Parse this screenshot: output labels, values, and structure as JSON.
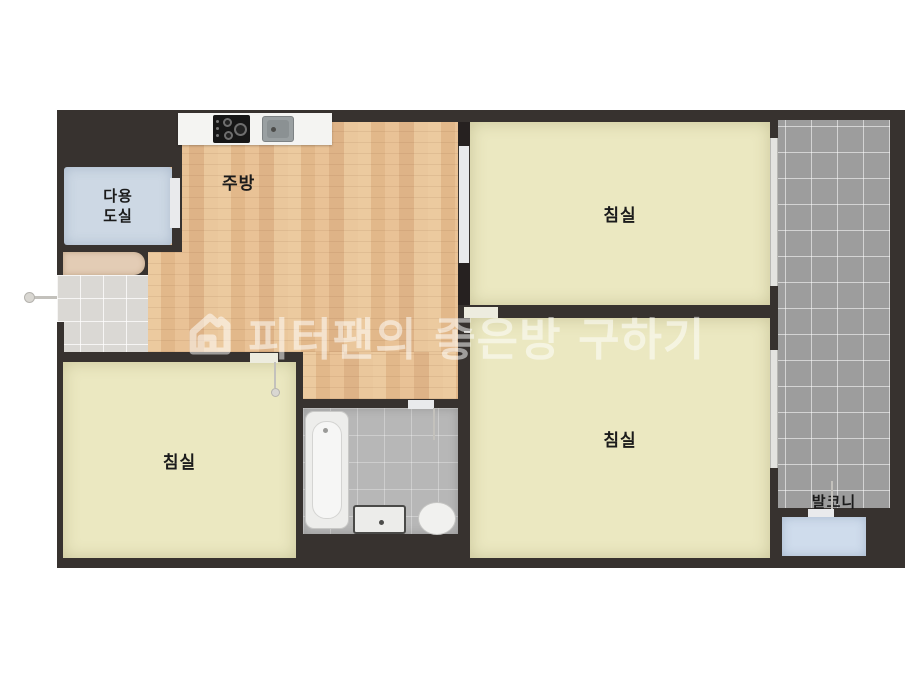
{
  "watermark": {
    "icon": "house-logo-icon",
    "text": "피터팬의 좋은방 구하기"
  },
  "rooms": {
    "kitchen": {
      "label": "주방"
    },
    "utility_room": {
      "label": "다용도실",
      "label_line1": "다용",
      "label_line2": "도실"
    },
    "bedroom_top_right": {
      "label": "침실"
    },
    "bedroom_bottom_right": {
      "label": "침실"
    },
    "bedroom_bottom_left": {
      "label": "침실"
    },
    "balcony": {
      "label": "발코니"
    }
  },
  "fixtures": {
    "kitchen_counter": "kitchen-counter",
    "stove": "gas-stove-icon",
    "kitchen_sink": "kitchen-sink-icon",
    "shoe_cabinet": "shoe-cabinet",
    "entrance_door": "entrance-door-handle-icon",
    "bathtub": "bathtub-icon",
    "washbasin": "washbasin-icon",
    "toilet": "toilet-icon",
    "balcony_storage": "balcony-storage-room"
  },
  "colors": {
    "wall": "#37322f",
    "wood_floor": "#e9c59c",
    "bedroom_floor": "#ebe8c1",
    "balcony_tile": "#9d9d9d",
    "bathroom_tile": "#b7b7b7",
    "utility_floor": "#cdd8e4",
    "storage_floor": "#cfdcec",
    "entry_tile": "#dad8d4",
    "counter": "#f4f4f2",
    "cabinet": "#e3ccb5"
  }
}
